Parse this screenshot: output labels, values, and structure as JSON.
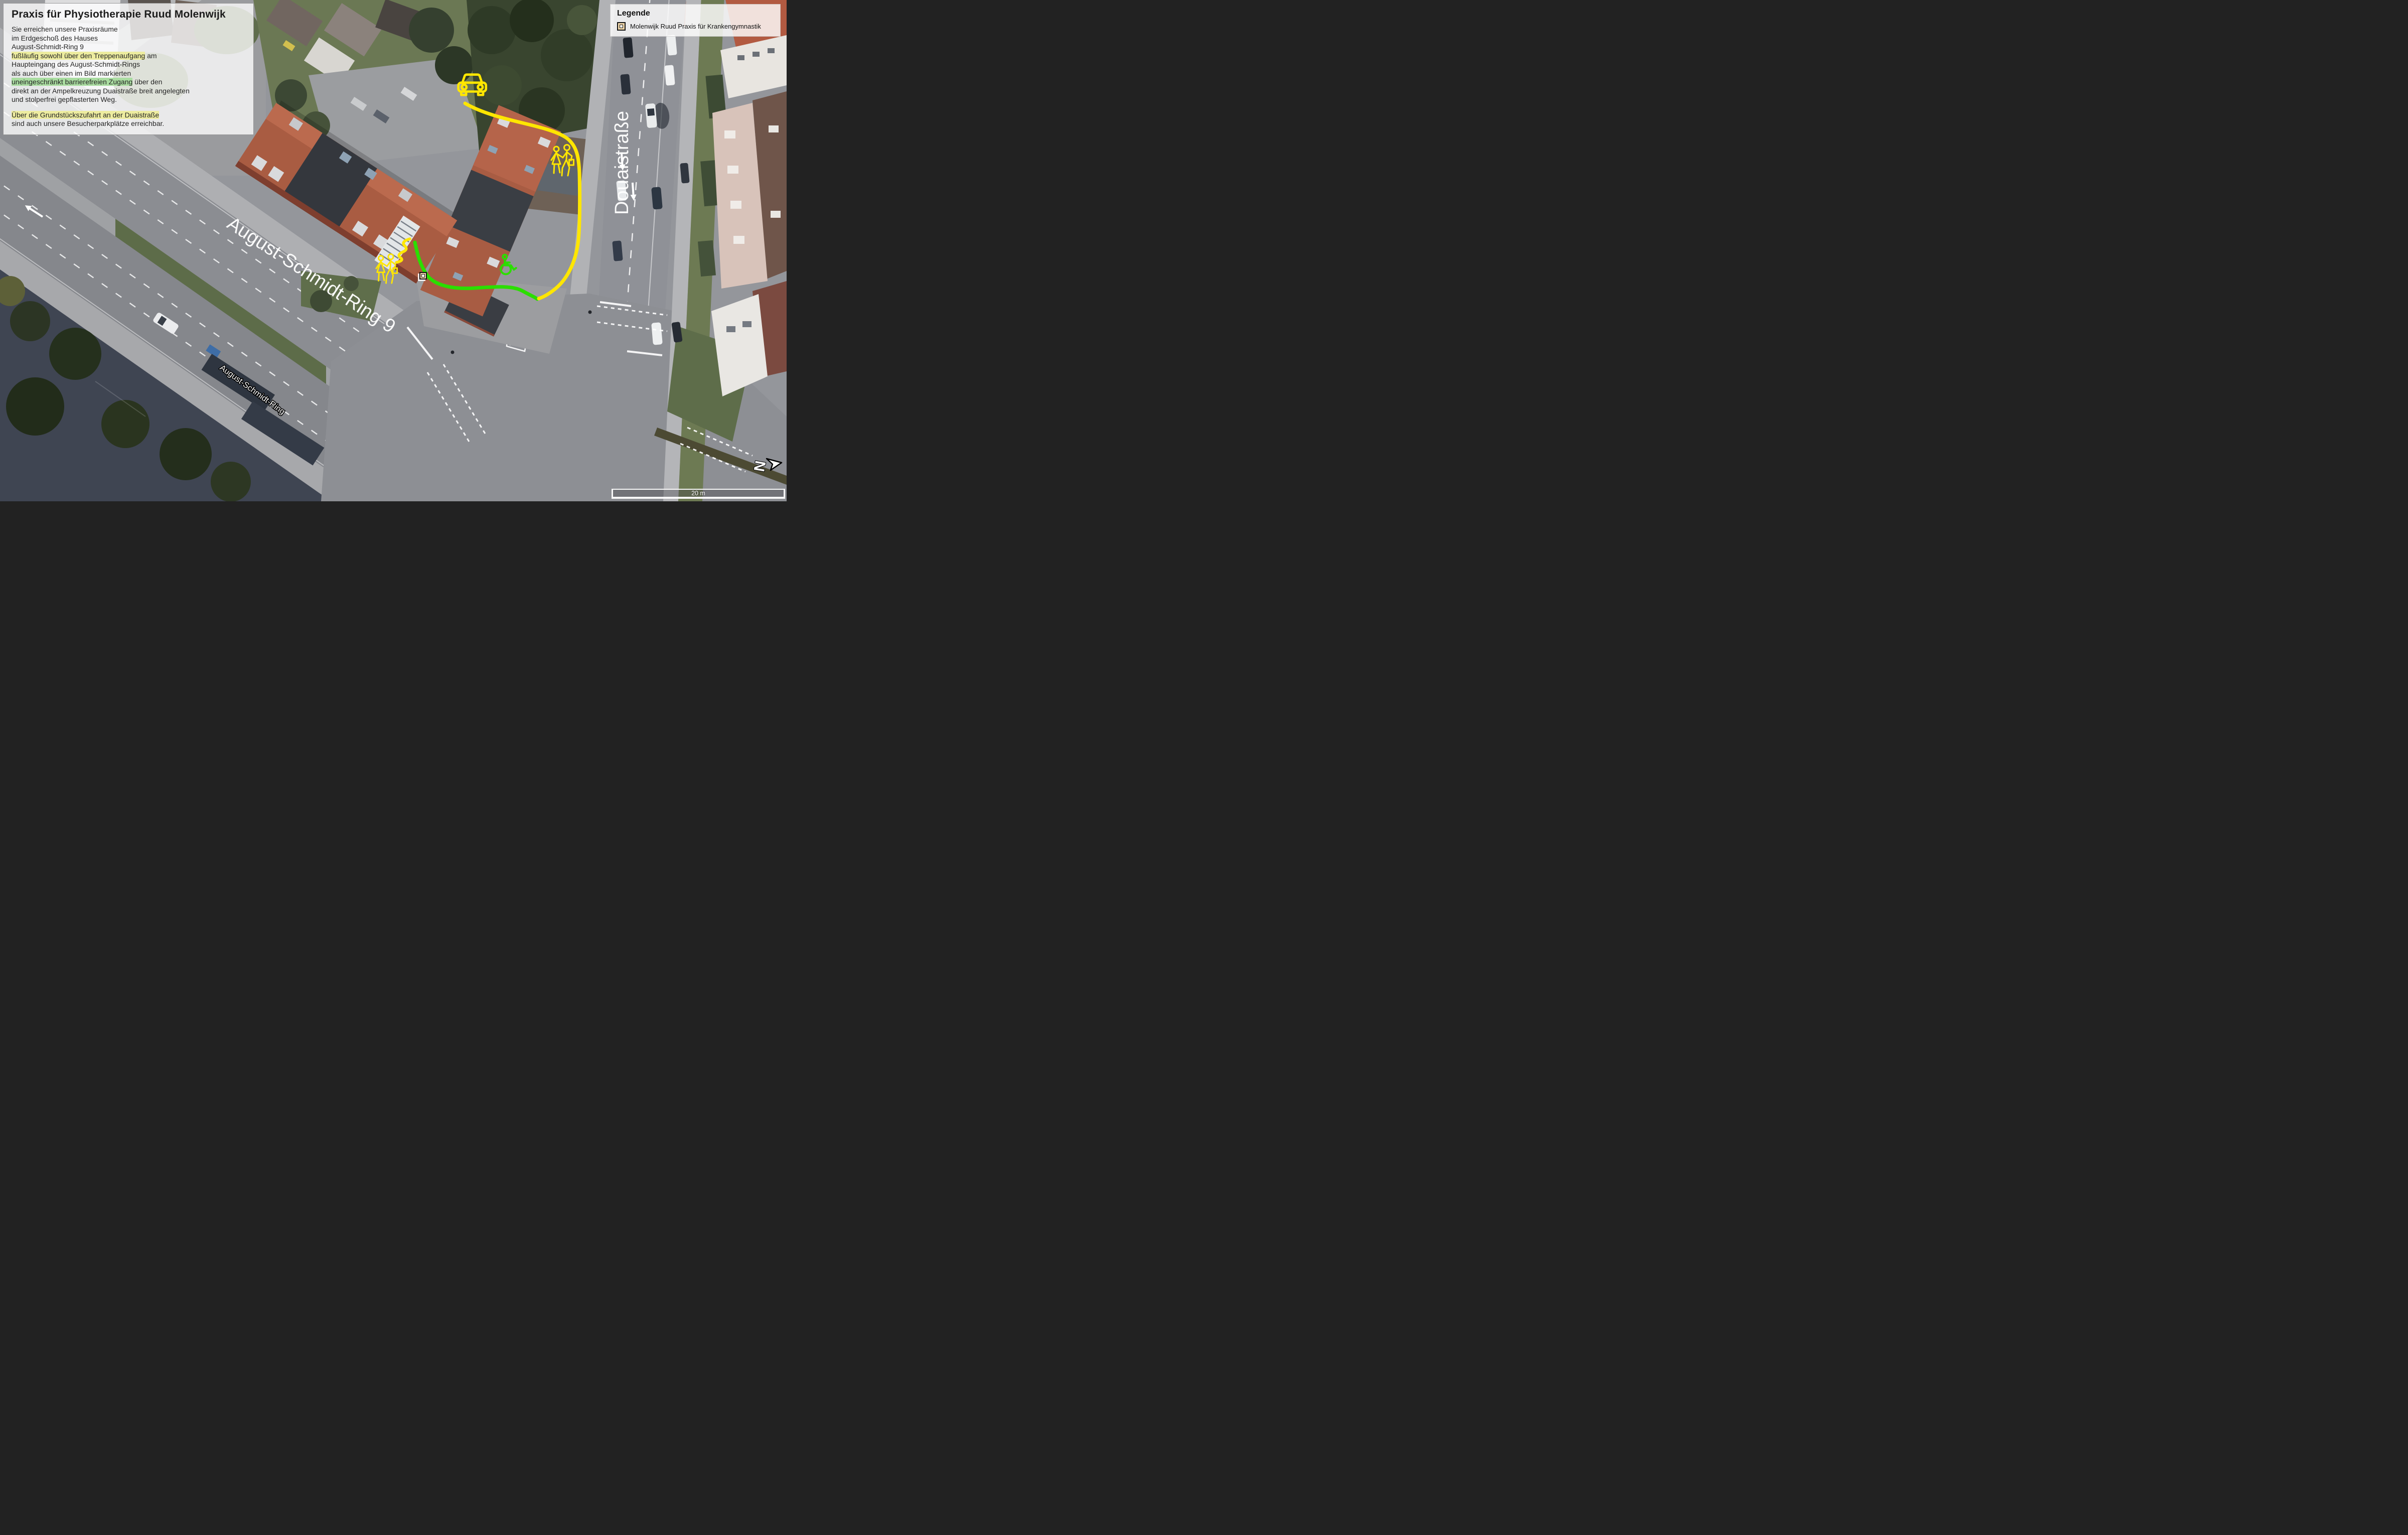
{
  "info_box": {
    "title": "Praxis für Physiotherapie Ruud Molenwijk",
    "lines": [
      {
        "segments": [
          {
            "text": "Sie erreichen unsere Praxisräume"
          }
        ]
      },
      {
        "segments": [
          {
            "text": "im Erdgeschoß des Hauses"
          }
        ]
      },
      {
        "segments": [
          {
            "text": "August-Schmidt-Ring 9"
          }
        ]
      },
      {
        "segments": [
          {
            "text": "fußläufig sowohl über den Treppenaufgang",
            "hl": "yellow"
          },
          {
            "text": " am"
          }
        ]
      },
      {
        "segments": [
          {
            "text": "Haupteingang des August-Schmidt-Rings"
          }
        ]
      },
      {
        "segments": [
          {
            "text": "als auch über einen im Bild markierten"
          }
        ]
      },
      {
        "segments": [
          {
            "text": "uneingeschränkt barrierefreien Zugang",
            "hl": "green"
          },
          {
            "text": " über den"
          }
        ]
      },
      {
        "segments": [
          {
            "text": "direkt an der Ampelkreuzung Duaistraße breit angelegten"
          }
        ]
      },
      {
        "segments": [
          {
            "text": "und stolperfrei gepflasterten Weg."
          }
        ]
      },
      {
        "segments": [
          {
            "text": ""
          }
        ]
      },
      {
        "segments": [
          {
            "text": "Über die Grundstückszufahrt an der Duaistraße",
            "hl": "yellow"
          }
        ]
      },
      {
        "segments": [
          {
            "text": "sind auch unsere Besucherparkplätze erreichbar."
          }
        ]
      }
    ]
  },
  "legend": {
    "title": "Legende",
    "items": [
      {
        "marker_icon": "praxis-marker-icon",
        "label": "Molenwijk Ruud Praxis für Krankengymnastik"
      }
    ]
  },
  "map": {
    "street_labels": {
      "primary": "August-Schmidt-Ring 9",
      "secondary": "Douaistraße",
      "tertiary": "August-Schmidt-Ring"
    },
    "routes": {
      "walk_drive_color": "#FFE600",
      "barrier_free_color": "#2BDE00"
    },
    "icons": [
      {
        "name": "car-icon",
        "color": "#FFE600"
      },
      {
        "name": "pedestrians-icon",
        "color": "#FFE600"
      },
      {
        "name": "stairs-icon",
        "color": "#FFE600"
      },
      {
        "name": "wheelchair-icon",
        "color": "#2BDE00"
      },
      {
        "name": "praxis-marker-icon",
        "color": "#F2D8AB"
      }
    ]
  },
  "scale_bar": {
    "label": "20 m"
  },
  "compass": {
    "letter": "N"
  },
  "highlights": {
    "yellow": "#EDEC9F",
    "green": "#A9DCA0"
  }
}
